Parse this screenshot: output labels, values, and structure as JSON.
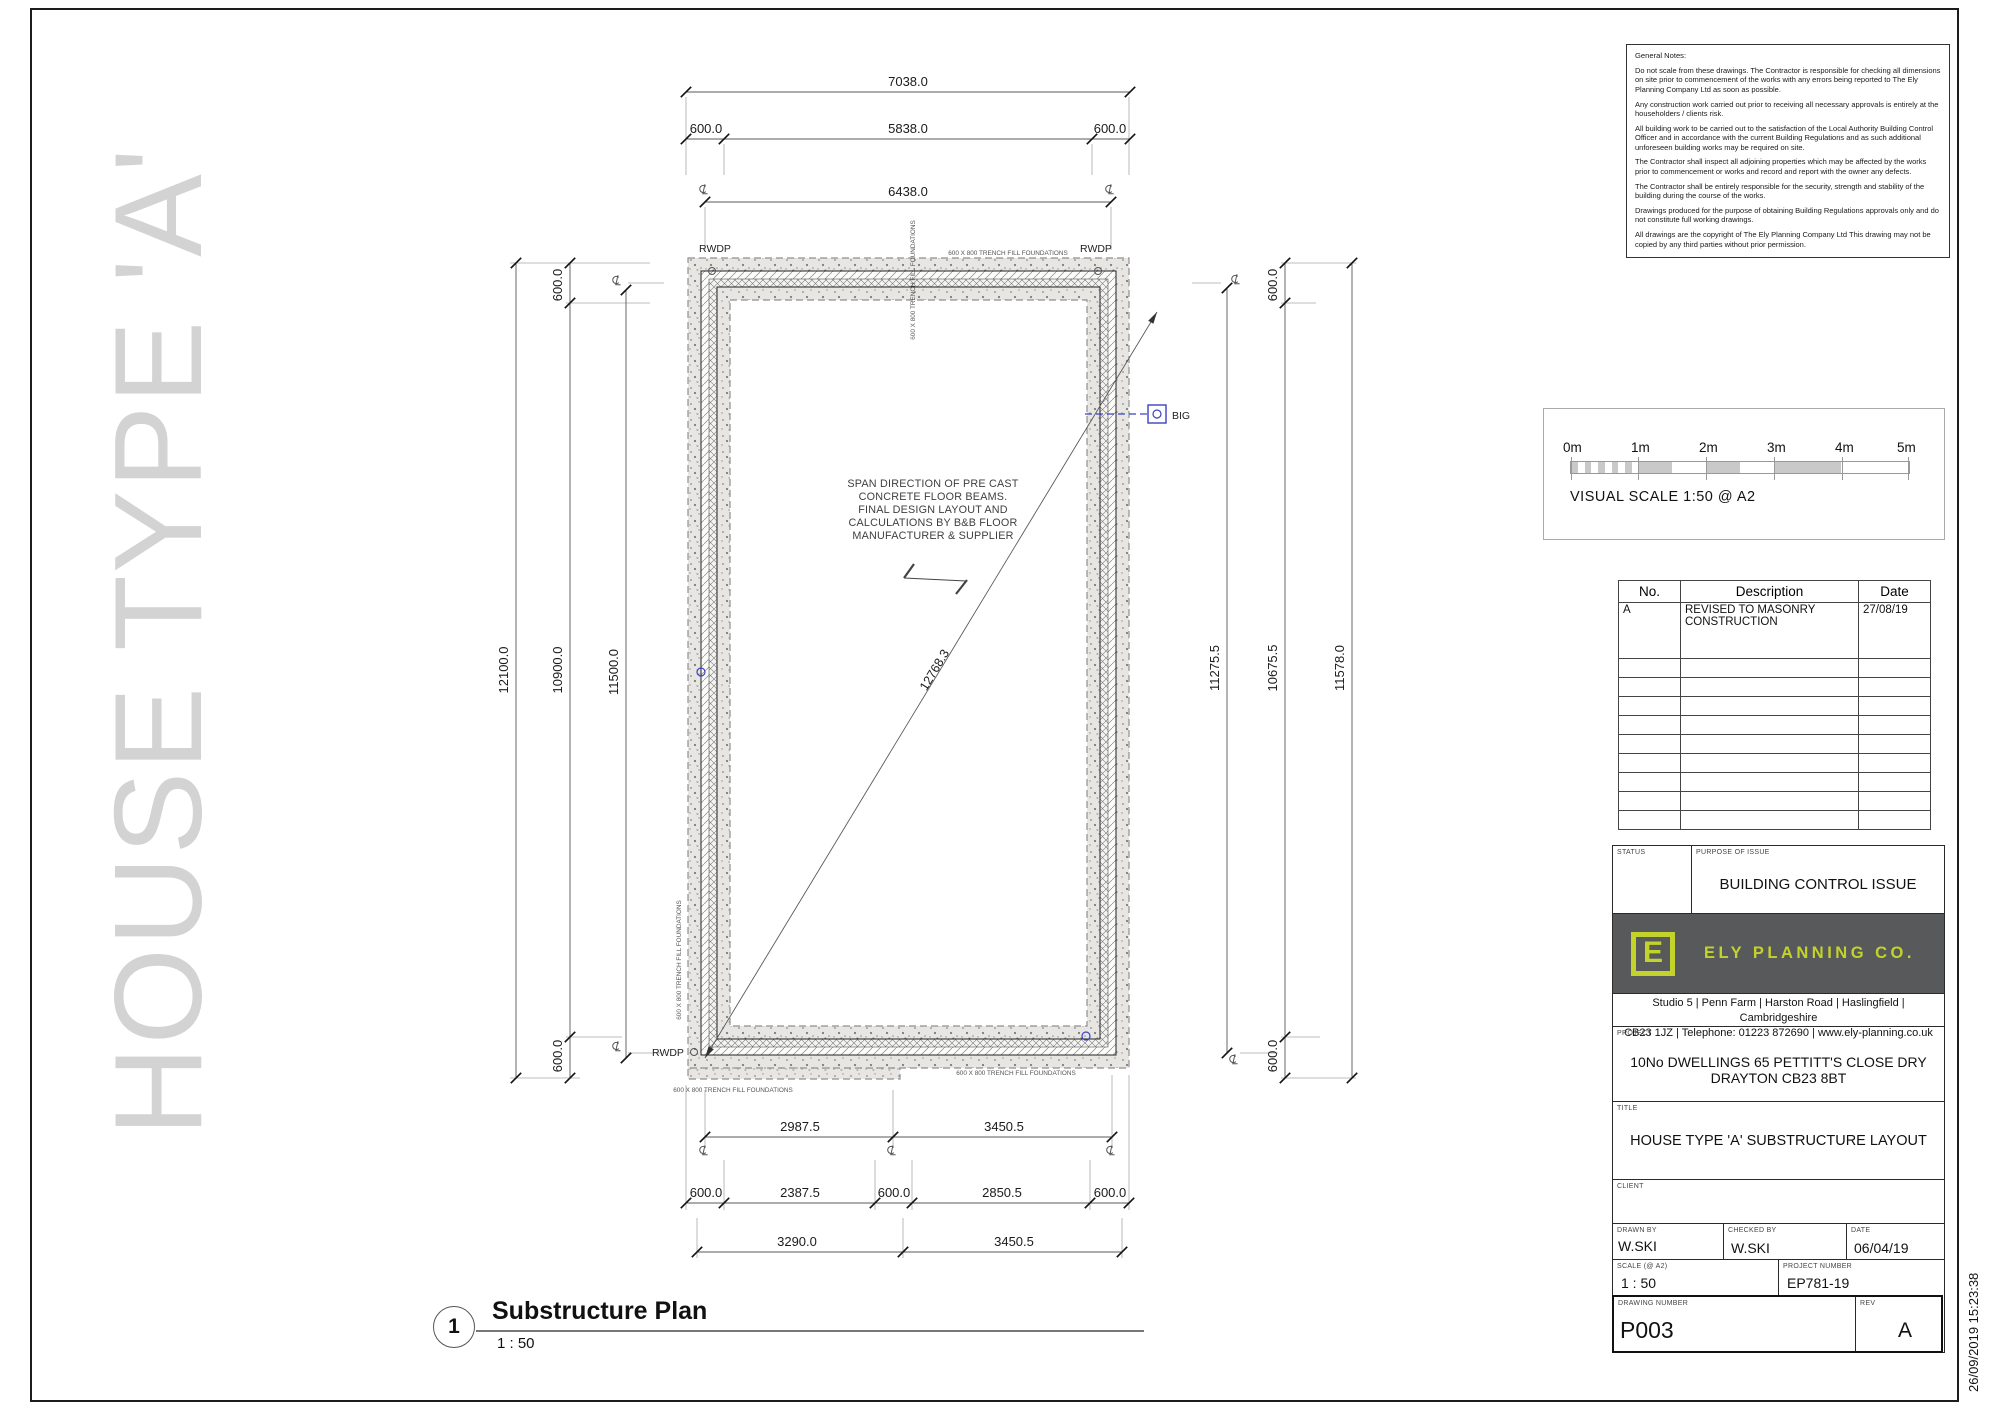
{
  "watermark": "HOUSE TYPE 'A'",
  "notes": {
    "title": "General Notes:",
    "paragraphs": [
      "Do not scale from these drawings. The Contractor is responsible for checking all dimensions on site prior to commencement of the works with any errors being reported to The Ely Planning Company Ltd as soon as possible.",
      "Any construction work carried out prior to receiving all necessary approvals is entirely at the householders / clients risk.",
      "All building work to be carried out to the satisfaction of the Local Authority Building Control Officer and in accordance with the current Building Regulations and as such additional unforeseen building works may be required on site.",
      "The Contractor shall inspect all adjoining properties which may be affected by the works prior to commencement or works and record and report with the owner any defects.",
      "The Contractor shall be entirely responsible for the security, strength and stability of the building during the course of the works.",
      "Drawings produced for the purpose of obtaining Building Regulations approvals only and do not constitute full working drawings.",
      "All drawings are the copyright of The Ely Planning Company Ltd This drawing may not be copied by any third parties without prior permission."
    ]
  },
  "scale_bar": {
    "labels": [
      "0m",
      "1m",
      "2m",
      "3m",
      "4m",
      "5m"
    ],
    "caption": "VISUAL SCALE 1:50  @ A2"
  },
  "revision_table": {
    "headers": [
      "No.",
      "Description",
      "Date"
    ],
    "rows": [
      {
        "no": "A",
        "description": "REVISED TO MASONRY CONSTRUCTION",
        "date": "27/08/19"
      }
    ]
  },
  "title_block": {
    "status_label": "STATUS",
    "purpose_label": "PURPOSE OF ISSUE",
    "purpose_value": "BUILDING CONTROL ISSUE",
    "company": "ELY PLANNING CO.",
    "logo_letter": "E",
    "address_line1": "Studio 5 | Penn Farm | Harston Road | Haslingfield | Cambridgeshire",
    "address_line2": "CB23 1JZ | Telephone: 01223 872690 | www.ely-planning.co.uk",
    "project_label": "PROJECT",
    "project_line1": "10No DWELLINGS 65 PETTITT'S CLOSE DRY",
    "project_line2": "DRAYTON CB23 8BT",
    "title_label": "TITLE",
    "title_value": "HOUSE TYPE 'A' SUBSTRUCTURE LAYOUT",
    "client_label": "CLIENT",
    "drawn_by_label": "DRAWN BY",
    "drawn_by": "W.SKI",
    "checked_by_label": "CHECKED BY",
    "checked_by": "W.SKI",
    "date_label": "DATE",
    "date": "06/04/19",
    "scale_label": "SCALE (@ A2)",
    "scale": "1 : 50",
    "project_number_label": "PROJECT NUMBER",
    "project_number": "EP781-19",
    "drawing_number_label": "DRAWING NUMBER",
    "drawing_number": "P003",
    "rev_label": "REV",
    "rev": "A"
  },
  "plan": {
    "callout_number": "1",
    "callout_title": "Substructure Plan",
    "callout_scale": "1 : 50",
    "note_lines": [
      "SPAN DIRECTION OF PRE CAST",
      "CONCRETE FLOOR BEAMS.",
      "FINAL DESIGN LAYOUT AND",
      "CALCULATIONS BY B&B FLOOR",
      "MANUFACTURER & SUPPLIER"
    ],
    "labels": {
      "rwdp": "RWDP",
      "big": "BIG",
      "trench": "600 X 800 TRENCH FILL FOUNDATIONS"
    },
    "dims": {
      "top_overall": "7038.0",
      "top_600_left": "600.0",
      "top_inner": "5838.0",
      "top_600_right": "600.0",
      "top_cl": "6438.0",
      "left_overall": "12100.0",
      "left_inner": "10900.0",
      "left_cl": "11500.0",
      "left_600_top": "600.0",
      "left_600_bottom": "600.0",
      "right_cl": "11275.5",
      "right_inner": "10675.5",
      "right_overall": "11578.0",
      "right_600_top": "600.0",
      "right_600_bottom": "600.0",
      "bottom_cl_left": "2987.5",
      "bottom_cl_right": "3450.5",
      "bottom_600_a": "600.0",
      "bottom_seg_left": "2387.5",
      "bottom_600_b": "600.0",
      "bottom_seg_right": "2850.5",
      "bottom_600_c": "600.0",
      "bottom_overall_left": "3290.0",
      "bottom_overall_right": "3450.5",
      "diagonal": "12768.3"
    }
  },
  "timestamp": "26/09/2019 15:23:38",
  "colors": {
    "accent": "#c3d32b",
    "logo_bg": "#58595b",
    "marker_blue": "#3a41c4",
    "watermark_gray": "#d3d3d3"
  }
}
